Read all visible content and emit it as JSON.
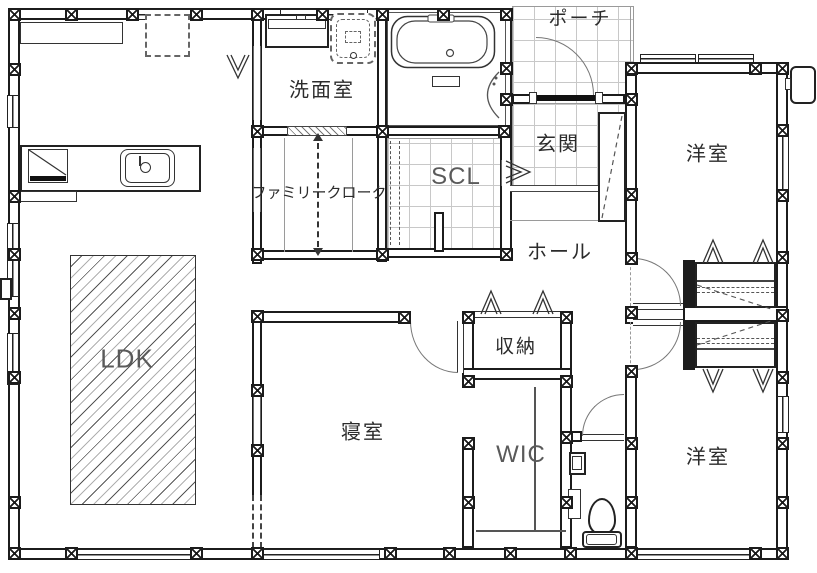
{
  "rooms": {
    "porch": "ポーチ",
    "washroom": "洗面室",
    "entrance": "玄関",
    "western_room_upper": "洋室",
    "shoe_closet": "SCL",
    "family_cloak": "ファミリークローク",
    "hall": "ホール",
    "ldk": "LDK",
    "storage": "収納",
    "bedroom": "寝室",
    "wic": "WIC",
    "western_room_lower": "洋室"
  },
  "colors": {
    "wall": "#1c1c1c",
    "tile_line": "#c8c8c8",
    "label_kanji": "#2b2b2b",
    "label_latin": "#5a5a5a"
  }
}
